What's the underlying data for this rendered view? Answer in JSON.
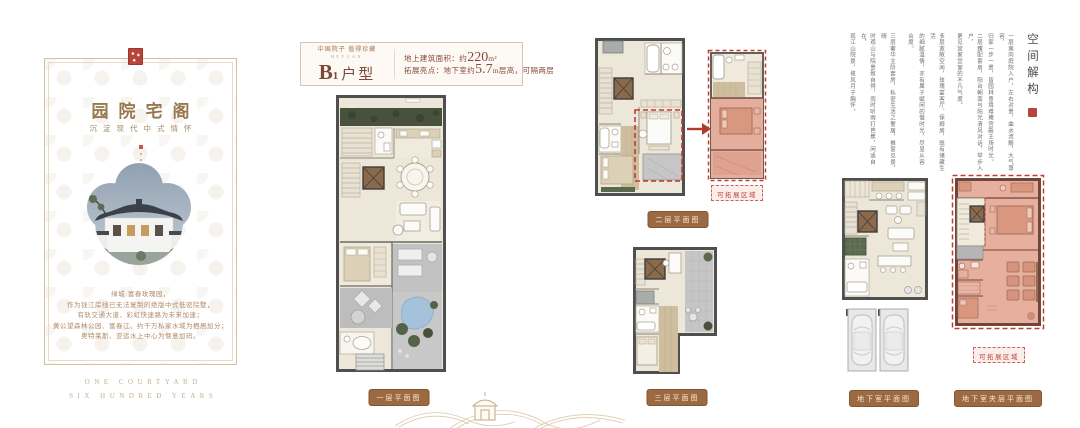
{
  "brand_card": {
    "title": "园院宅阁",
    "subtitle": "沉淀现代中式情怀",
    "paragraph_lines": [
      "绿城·富春玫瑰园，",
      "作为钱江岸线已无法复制的绝版中式低密院墅，",
      "有轨交通大道、彩虹快速路为未来加速；",
      "黄公望森林公园、富春江、约千万私家水域为栖居加分；",
      "奥特莱斯、亚运水上中心为惬意加码。"
    ],
    "footer_en_line1": "ONE COURTYARD",
    "footer_en_line2": "SIX HUNDRED YEARS"
  },
  "unit_header": {
    "tagline_cn": "中国院子 值得珍藏",
    "tagline_en": "HEYUAN",
    "unit_b": "B",
    "unit_sub": "1",
    "unit_suffix": "户型",
    "line1_label": "地上建筑面积：约",
    "line1_value": "220",
    "line1_unit": "m²",
    "line2_label": "拓展亮点：地下室约",
    "line2_value": "5.7",
    "line2_unit": "m层高，可隔两层"
  },
  "plans": {
    "floor1_caption": "一层平面图",
    "floor2_caption": "二层平面图",
    "floor3_caption": "三层平面图",
    "basement_caption": "地下室平面图",
    "mezzanine_caption": "地下室夹层平面图",
    "expandable_badge": "可拓展区域"
  },
  "deconstruction": {
    "title": "空间解构",
    "paragraphs": [
      [
        "一层南向庭院入户，左右对景，曲水流觞，大气尊容，",
        "归家一步一景，皆园林意境难掩宫殿主场时光。",
        "二层臻配套房，阳台朝南与阳光清风对话，举步入户，",
        "更见宜家宜室的不凡气度。"
      ],
      [
        "多层宽敞空间，玫瑰宴客厅、保姆房，既有储藏生活",
        "的细腻温情，亦有属于赋闲的慢时光，尽显从容",
        "合度。"
      ],
      [
        "三层奢华主阶套房，私密生活之奢居，推窗见景，晴",
        "时观山与院景致自得，雨时听雨打芭蕉，闲适自在，",
        "现江山院景，揽风月于胸怀。"
      ]
    ]
  },
  "colors": {
    "brand_gold": "#97784E",
    "maroon": "#8A4A38",
    "badge_brown": "#9C6A42",
    "expand_red": "#C23B2E",
    "expand_pink": "#E4AD9C",
    "seal_red": "#B8453C",
    "pond_blue": "#A4C3DB",
    "garden_green": "#47513B"
  }
}
